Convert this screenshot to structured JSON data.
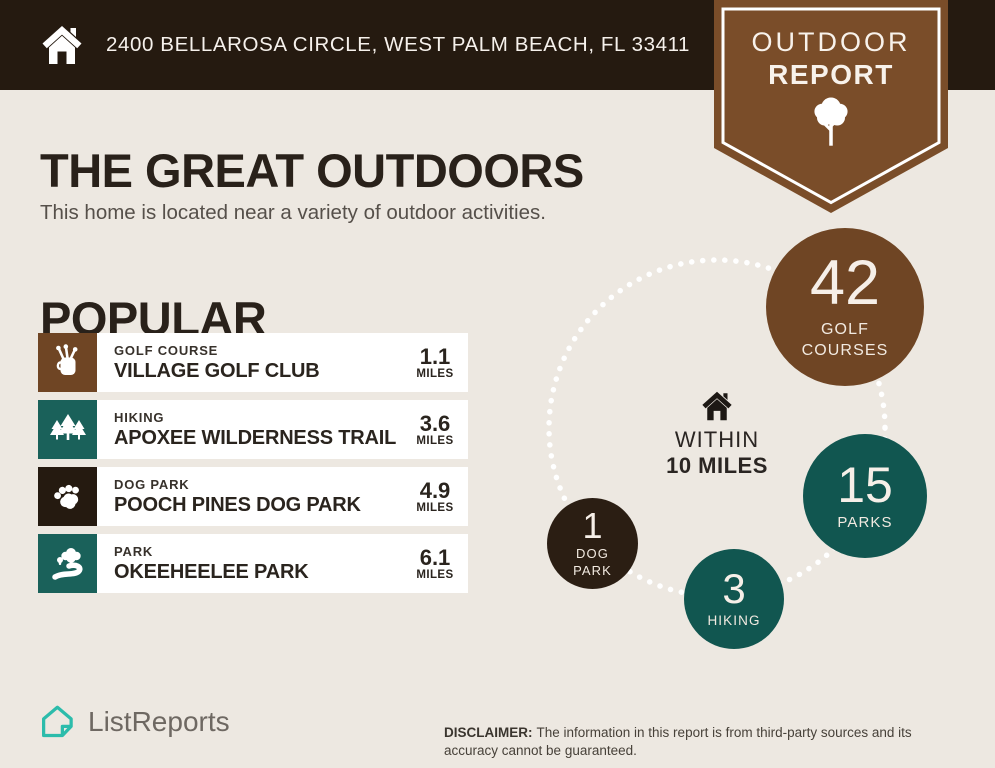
{
  "colors": {
    "background": "#EDE8E1",
    "header_bg": "#251A10",
    "badge_brown": "#7A4D29",
    "golf_brown": "#6F4524",
    "teal_square": "#1A615A",
    "teal_circle": "#115650",
    "dark_brown_circle": "#2B1E13",
    "dark_square": "#251A10",
    "row_bg": "#FFFFFF",
    "brand_teal": "#2CBCAB",
    "dot_white": "#FFFFFF"
  },
  "header": {
    "address": "2400 BELLAROSA CIRCLE, WEST PALM BEACH, FL 33411"
  },
  "badge": {
    "line1": "OUTDOOR",
    "line2": "REPORT"
  },
  "intro": {
    "title": "THE GREAT OUTDOORS",
    "subtitle": "This home is located near a variety of outdoor activities."
  },
  "popular": {
    "heading": "POPULAR",
    "places": [
      {
        "category": "GOLF COURSE",
        "name": "VILLAGE GOLF CLUB",
        "distance": "1.1",
        "unit": "MILES",
        "icon": "golf-bag-icon",
        "color": "#6F4524"
      },
      {
        "category": "HIKING",
        "name": "APOXEE WILDERNESS TRAIL",
        "distance": "3.6",
        "unit": "MILES",
        "icon": "pine-trees-icon",
        "color": "#1A615A"
      },
      {
        "category": "DOG PARK",
        "name": "POOCH PINES DOG PARK",
        "distance": "4.9",
        "unit": "MILES",
        "icon": "paw-icon",
        "color": "#251A10"
      },
      {
        "category": "PARK",
        "name": "OKEEHEELEE PARK",
        "distance": "6.1",
        "unit": "MILES",
        "icon": "park-path-icon",
        "color": "#1A615A"
      }
    ]
  },
  "radius_chart": {
    "type": "bubble",
    "center": {
      "icon": "home-icon",
      "line1": "WITHIN",
      "line2": "10 MILES"
    },
    "bubbles": [
      {
        "value": "42",
        "label1": "GOLF",
        "label2": "COURSES",
        "color": "#6F4524"
      },
      {
        "value": "15",
        "label1": "PARKS",
        "color": "#115650"
      },
      {
        "value": "3",
        "label1": "HIKING",
        "color": "#115650"
      },
      {
        "value": "1",
        "label1": "DOG",
        "label2": "PARK",
        "color": "#2B1E13"
      }
    ]
  },
  "footer": {
    "brand": "ListReports",
    "disclaimer_label": "DISCLAIMER:",
    "disclaimer_text": "The information in this report is from third-party sources and its accuracy cannot be guaranteed."
  }
}
